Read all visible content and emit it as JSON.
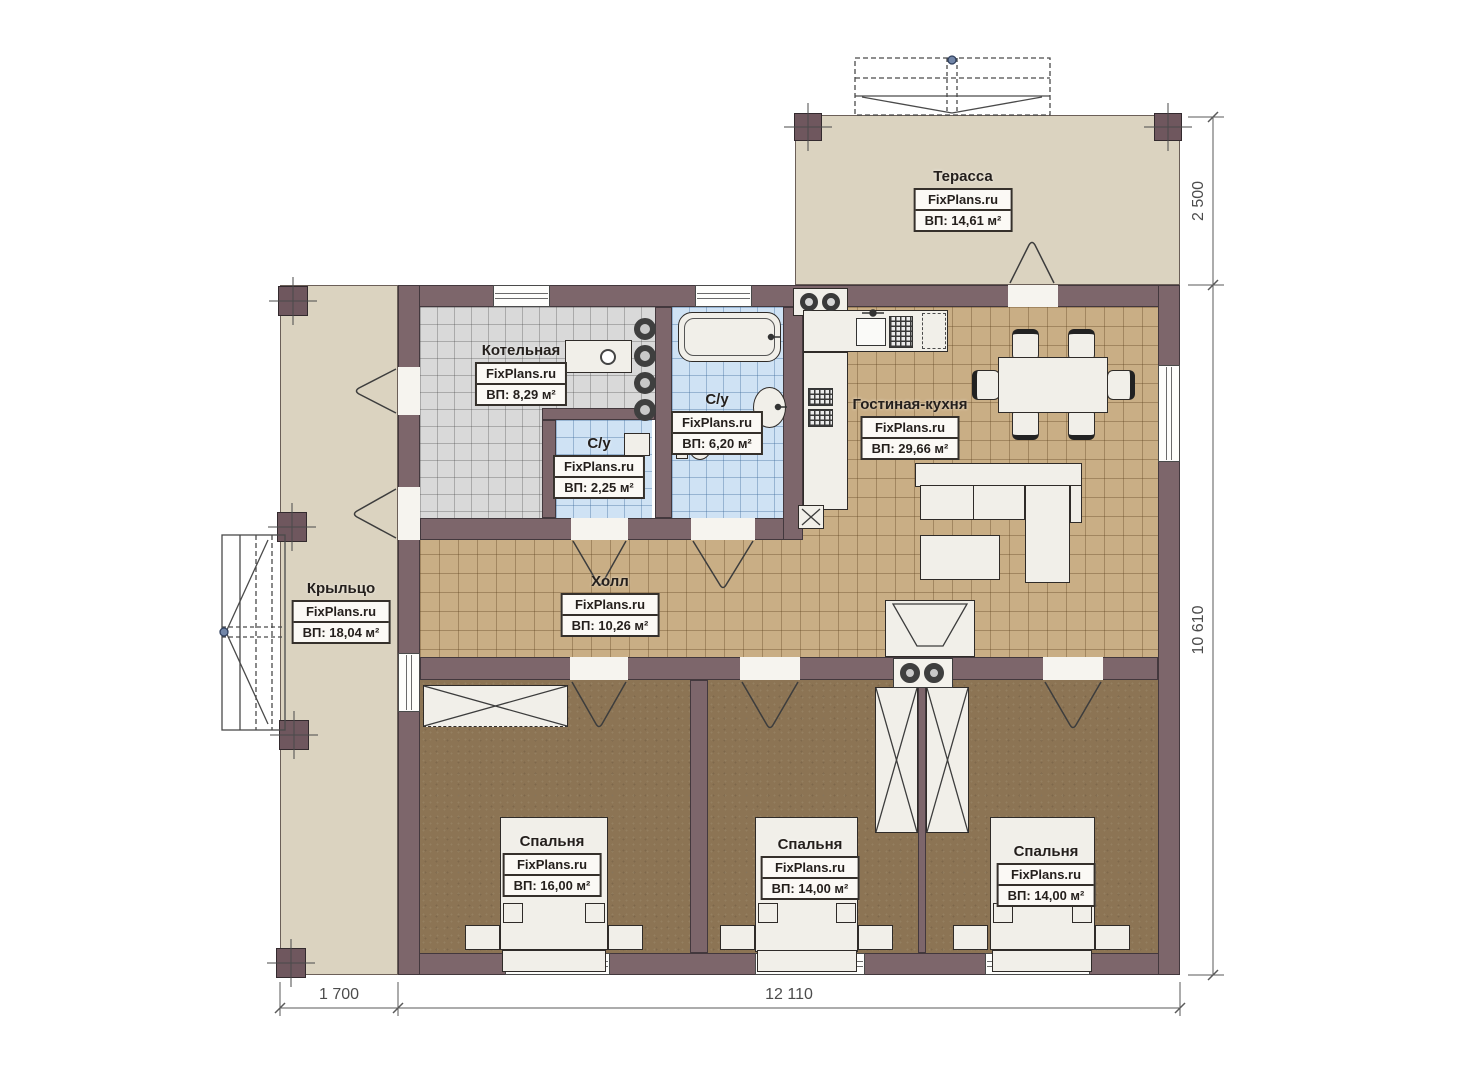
{
  "site_label": "FixPlans.ru",
  "rooms": {
    "terrace": {
      "name": "Терасса",
      "area": "ВП: 14,61 м²"
    },
    "boiler": {
      "name": "Котельная",
      "area": "ВП: 8,29 м²"
    },
    "bath_large": {
      "name": "С/у",
      "area": "ВП: 6,20 м²"
    },
    "bath_small": {
      "name": "С/у",
      "area": "ВП: 2,25 м²"
    },
    "living_kitchen": {
      "name": "Гостиная-кухня",
      "area": "ВП: 29,66 м²"
    },
    "hall": {
      "name": "Холл",
      "area": "ВП: 10,26 м²"
    },
    "porch": {
      "name": "Крыльцо",
      "area": "ВП: 18,04 м²"
    },
    "bedroom_1": {
      "name": "Спальня",
      "area": "ВП: 16,00 м²"
    },
    "bedroom_2": {
      "name": "Спальня",
      "area": "ВП: 14,00 м²"
    },
    "bedroom_3": {
      "name": "Спальня",
      "area": "ВП: 14,00 м²"
    }
  },
  "dimensions": {
    "terrace_depth": "2 500",
    "house_depth": "10 610",
    "porch_width": "1 700",
    "house_width": "12 110"
  }
}
